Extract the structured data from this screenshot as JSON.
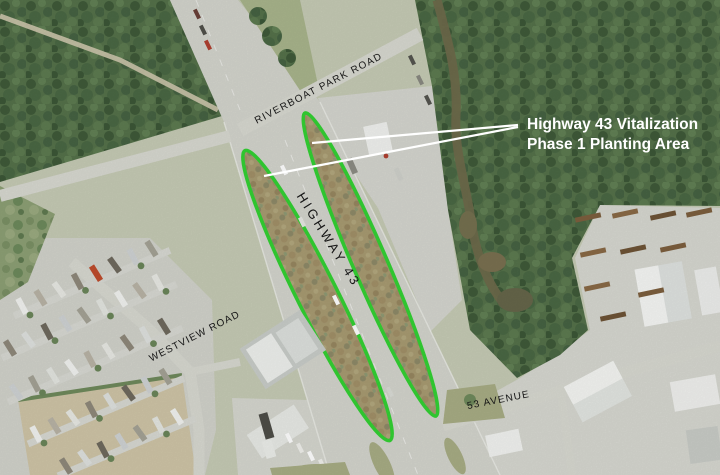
{
  "map": {
    "background_color": "#c6cbb5",
    "annotation": {
      "line1": "Highway 43 Vitalization",
      "line2": "Phase 1 Planting Area",
      "color": "#ffffff"
    },
    "planting_outline_color": "#33d233",
    "leader_line_color": "#ffffff",
    "label_color": "#161616",
    "road_labels": {
      "riverboat": "RIVERBOAT PARK ROAD",
      "highway43": "HIGHWAY 43",
      "westview": "WESTVIEW ROAD",
      "avenue53": "53 AVENUE"
    }
  }
}
